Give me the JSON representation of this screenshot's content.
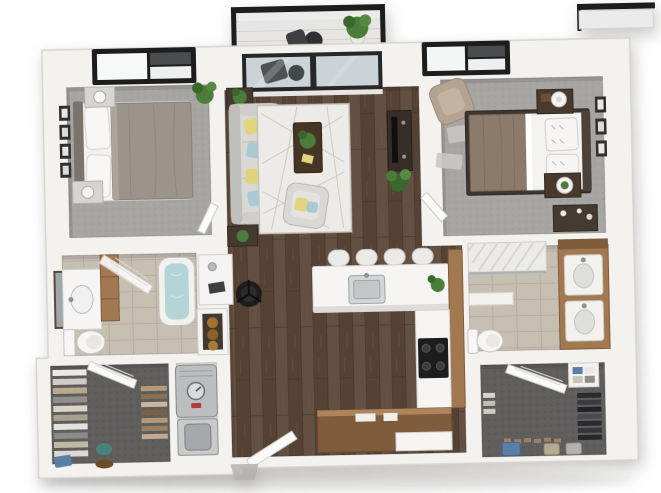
{
  "scene": {
    "type": "3d-floor-plan",
    "description": "Top-down 3D dollhouse render of a two-bedroom, two-bathroom apartment with balcony",
    "background": "#ffffff",
    "no_visible_text": true
  },
  "palette": {
    "wall": "#f3f2ef",
    "wallEdge": "#d7d4d0",
    "wallShadow": "#c4c1bd",
    "wood": "#5b4738",
    "woodDark": "#47362b",
    "woodLight": "#6e5845",
    "carpet": "#a6a5a2",
    "closetCarpet": "#5f5e5c",
    "tile": "#c8bfb3",
    "tileLine": "#b0a79a",
    "balconyFloor": "#e6e5e3",
    "counter": "#f6f5f3",
    "cabinet": "#a1784f",
    "cabinetDark": "#7f5c3c",
    "sofa": "#d9d8d5",
    "sofaShade": "#c0bfbc",
    "rug": "#edebe7",
    "rugLine": "#c7c3bd",
    "bedGray": "#9a948b",
    "bedWhite": "#f4f3f0",
    "blanket": "#8c7b6a",
    "headboard": "#4b423b",
    "pillowYellow": "#e1d47c",
    "pillowTeal": "#a8cad4",
    "armchairTan": "#b4a391",
    "darkFurniture": "#453a30",
    "black": "#1d1d1d",
    "plant": "#4c7c3a",
    "plantDark": "#3a672c",
    "water": "#b4d5d7",
    "glass": "#ccd3d6",
    "metal": "#bcbdbf",
    "toiletWhite": "#f7f6f4",
    "towel": "#a0722e",
    "accentBlue": "#5a7fa6",
    "accentTeal": "#47837a",
    "accentTan": "#b7aa92"
  },
  "rooms": [
    {
      "name": "balcony",
      "floor": "light decking",
      "items": [
        "black metal railing",
        "potted plant",
        "bistro table and chair seen through glass"
      ]
    },
    {
      "name": "bedroom-1",
      "floor": "gray carpet",
      "items": [
        "black framed window",
        "bed with gray duvet",
        "two nightstands with lamps",
        "four wall art frames",
        "potted plant",
        "open door"
      ]
    },
    {
      "name": "living-room",
      "floor": "dark hardwood",
      "items": [
        "sliding glass balcony door",
        "sofa with yellow and teal pillows",
        "two side tables with plants",
        "geometric area rug",
        "coffee table with plant",
        "accent armchair",
        "media console with tv",
        "floor plant"
      ]
    },
    {
      "name": "bedroom-2",
      "floor": "gray carpet",
      "items": [
        "black framed window",
        "tan armchair",
        "bed with white duvet and taupe throw",
        "two nightstands",
        "three wall art frames",
        "dresser",
        "open door"
      ]
    },
    {
      "name": "bathroom-1",
      "floor": "beige tile",
      "items": [
        "vanity with mirror and sink",
        "tall cabinet",
        "toilet",
        "bathtub with water",
        "glass shower door"
      ]
    },
    {
      "name": "desk-nook",
      "floor": "hardwood",
      "items": [
        "white desk with lamp",
        "black office chair",
        "linen shelf with towels"
      ]
    },
    {
      "name": "kitchen",
      "floor": "dark hardwood",
      "items": [
        "white island with sink",
        "four bar stools",
        "cabinet run",
        "black stove",
        "lower cabinets",
        "plant on counter"
      ]
    },
    {
      "name": "bathroom-2",
      "floor": "beige tile",
      "items": [
        "tiled shower",
        "half wall",
        "toilet",
        "double vanity with two sinks",
        "upper cabinet"
      ]
    },
    {
      "name": "walk-in-closet-1",
      "floor": "charcoal carpet",
      "items": [
        "hanging clothes both sides",
        "open door",
        "blue bag",
        "teal bag",
        "shoes"
      ]
    },
    {
      "name": "utility-closet",
      "floor": "light gray",
      "items": [
        "water heater with dial",
        "front-load washer"
      ]
    },
    {
      "name": "walk-in-closet-2",
      "floor": "charcoal carpet",
      "items": [
        "open door",
        "shelf with folded clothes",
        "dark hanging garments",
        "storage bins",
        "shoe row"
      ]
    },
    {
      "name": "entry",
      "items": [
        "open entry door",
        "threshold step"
      ]
    }
  ]
}
